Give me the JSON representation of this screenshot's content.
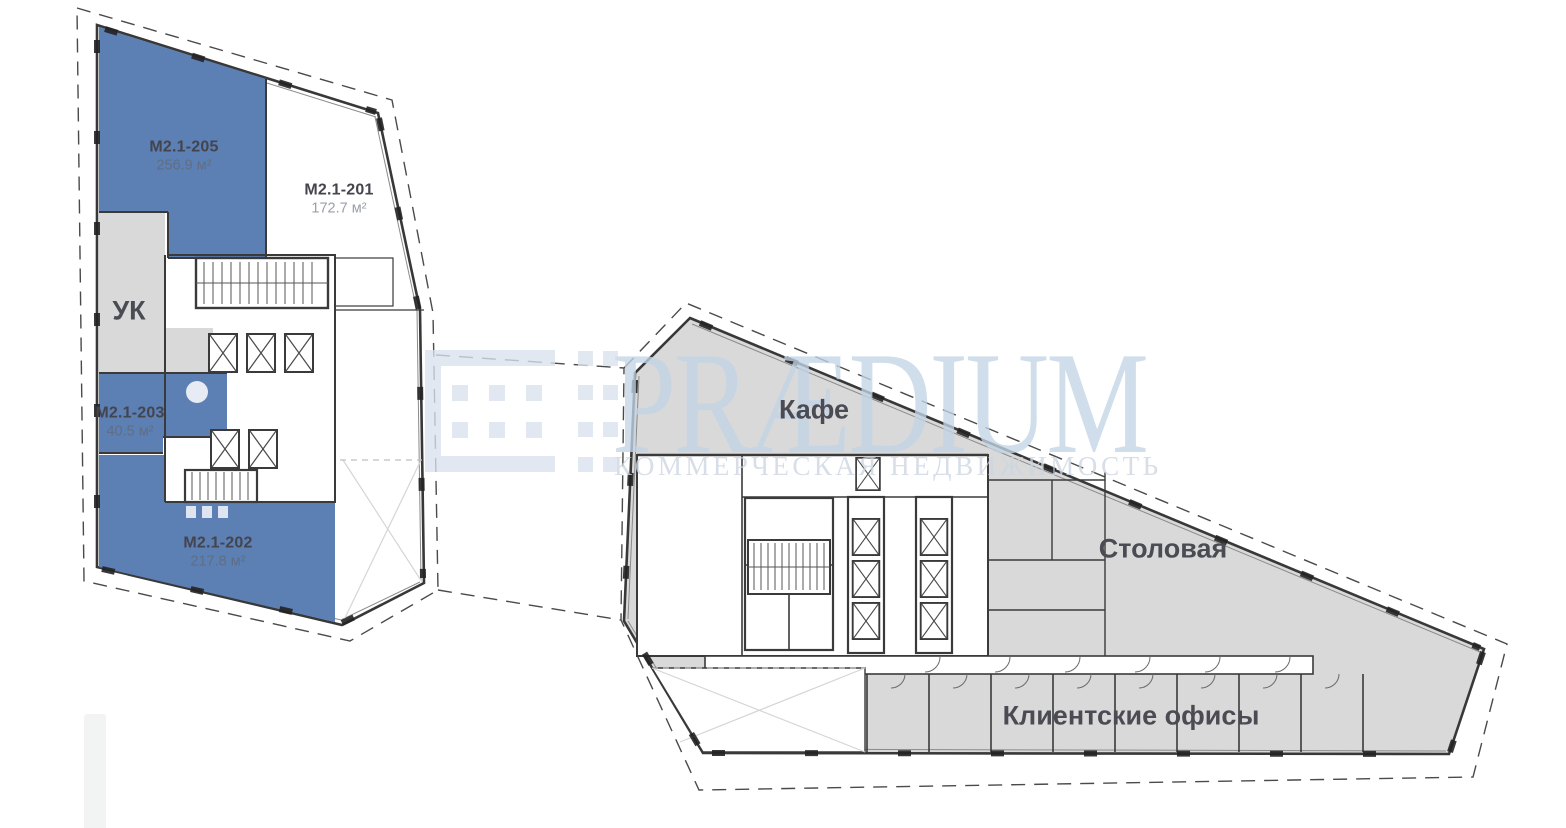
{
  "watermark": {
    "brand": "PRÆDIUM",
    "subtitle": "КОММЕРЧЕСКАЯ НЕДВИЖИМОСТЬ"
  },
  "units": [
    {
      "id": "М2.1-205",
      "area": "256.9 м²"
    },
    {
      "id": "М2.1-201",
      "area": "172.7 м²"
    },
    {
      "id": "М2.1-203",
      "area": "40.5 м²"
    },
    {
      "id": "М2.1-202",
      "area": "217.8 м²"
    }
  ],
  "zones": {
    "uk": "УК",
    "cafe": "Кафе",
    "canteen": "Столовая",
    "client_offices": "Клиентские офисы"
  },
  "palette": {
    "available_unit": "#5c7fb4",
    "common_area": "#d9d9d9",
    "walls": "#3a3a3a",
    "watermark_blue": "#c3d5e7",
    "boundary_dash": "#4a4a4a"
  }
}
